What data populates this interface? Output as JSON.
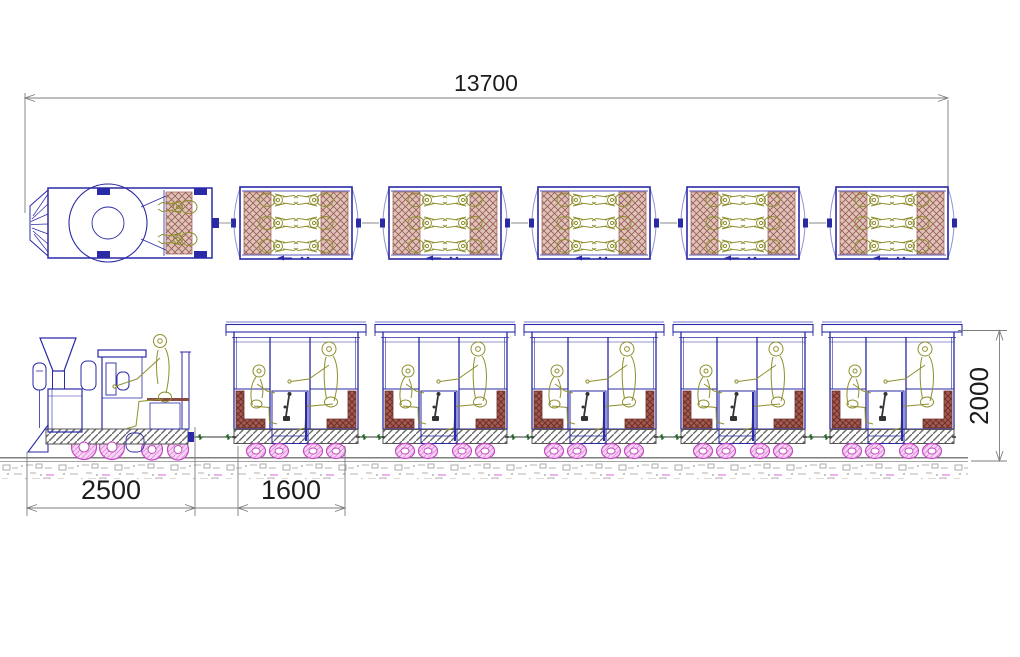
{
  "drawing": {
    "views": [
      "plan-view-top",
      "side-elevation-bottom"
    ],
    "dimensions": {
      "total_length": {
        "label": "13700"
      },
      "locomotive_length": {
        "label": "2500"
      },
      "carriage_length": {
        "label": "1600"
      },
      "overall_height": {
        "label": "2000"
      }
    },
    "train": {
      "locomotive_count": 1,
      "carriage_count": 5,
      "plan_passengers_per_carriage": 6,
      "plan_locomotive_crew": 2,
      "side_passengers_per_carriage": 2,
      "side_locomotive_driver": 1
    },
    "colors": {
      "outline": "#2a2aa6",
      "outline_light": "#9093d2",
      "figure": "#8f8f2e",
      "seat": "#8a4a42",
      "seat_fill_plan": "#ddc4bb",
      "seat_hatch_plan": "#9b5a50",
      "seat_fill_side": "#a25a52",
      "seat_hatch_side": "#6e3028",
      "wheel": "#c44ac4",
      "wheel_fill": "#f7d6f4",
      "wheel_hatch": "#e291de",
      "platform_line": "#6a6a6a",
      "ground": "#9a9a9a",
      "ground_accent": "#d66ad6",
      "coupling_accent": "#2e7d32",
      "dimension_line": "#7c7c7c",
      "dimension_text": "#1c1c1c"
    }
  }
}
